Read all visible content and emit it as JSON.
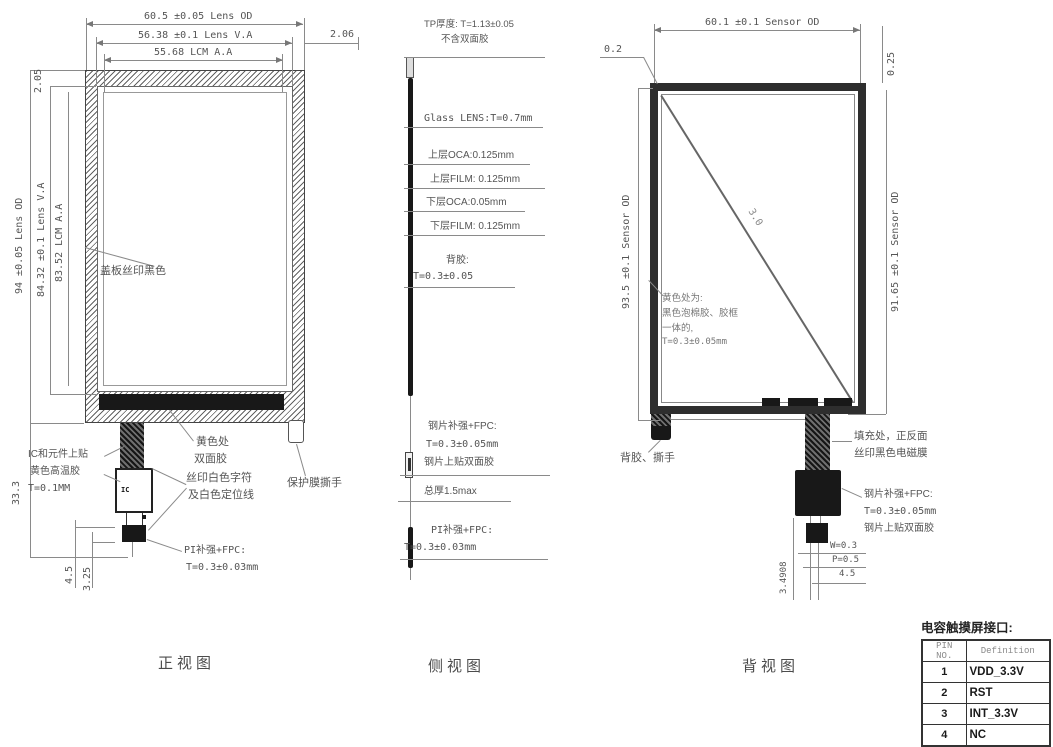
{
  "drawing": {
    "front": {
      "title": "正视图",
      "dim_lens_od_w": "60.5 ±0.05 Lens OD",
      "dim_lens_va_w": "56.38 ±0.1 Lens V.A",
      "dim_lcm_aa_w": "55.68 LCM A.A",
      "dim_offset_right": "2.06",
      "dim_offset_top": "2.05",
      "dim_lens_od_h": "94 ±0.05 Lens OD",
      "dim_lens_va_h": "84.32 ±0.1 Lens V.A",
      "dim_lcm_aa_h": "83.52 LCM A.A",
      "dim_tail_total": "33.3",
      "dim_tail_a": "4.5",
      "dim_tail_b": "3.25",
      "label_cover": "盖板丝印黑色",
      "label_ic_1": "IC和元件上贴",
      "label_ic_2": "黄色高温胶",
      "label_ic_3": "T=0.1MM",
      "label_yellow_1": "黄色处",
      "label_yellow_2": "双面胶",
      "label_silk_1": "丝印白色字符",
      "label_silk_2": "及白色定位线",
      "label_protect": "保护膜撕手",
      "label_pi_1": "PI补强+FPC:",
      "label_pi_2": "T=0.3±0.03mm",
      "ic_text": "IC"
    },
    "side": {
      "title": "侧视图",
      "tp_1": "TP厚度: T=1.13±0.05",
      "tp_2": "不含双面胶",
      "glass": "Glass LENS:T=0.7mm",
      "oca_top": "上层OCA:0.125mm",
      "film_top": "上层FILM: 0.125mm",
      "oca_bot": "下层OCA:0.05mm",
      "film_bot": "下层FILM: 0.125mm",
      "adhesive_1": "背胶:",
      "adhesive_2": "T=0.3±0.05",
      "steel_1": "钢片补强+FPC:",
      "steel_2": "T=0.3±0.05mm",
      "steel_3": "钢片上贴双面胶",
      "total": "总厚1.5max",
      "pi_1": "PI补强+FPC:",
      "pi_2": "T=0.3±0.03mm"
    },
    "back": {
      "title": "背视图",
      "dim_sensor_od_w": "60.1 ±0.1 Sensor OD",
      "dim_left_offset": "0.2",
      "dim_right_offset": "0.25",
      "dim_sensor_od_h_left": "93.5 ±0.1 Sensor OD",
      "dim_sensor_od_h_right": "91.65 ±0.1 Sensor OD",
      "diag_label": "3.0",
      "foam_1": "黄色处为:",
      "foam_2": "黑色泡棉胶、胶框",
      "foam_3": "一体的,",
      "foam_4": "T=0.3±0.05mm",
      "label_back_adhesive": "背胶、撕手",
      "fill_1": "填充处，正反面",
      "fill_2": "丝印黑色电磁膜",
      "steel_1": "钢片补强+FPC:",
      "steel_2": "T=0.3±0.05mm",
      "steel_3": "钢片上贴双面胶",
      "dim_w": "W=0.3",
      "dim_p": "P=0.5",
      "dim_45": "4.5",
      "dim_349": "3.4908"
    },
    "pin_table": {
      "title": "电容触摸屏接口:",
      "headers": [
        "PIN NO.",
        "Definition"
      ],
      "rows": [
        {
          "pin": "1",
          "def": "VDD_3.3V"
        },
        {
          "pin": "2",
          "def": "RST"
        },
        {
          "pin": "3",
          "def": "INT_3.3V"
        },
        {
          "pin": "4",
          "def": "NC"
        }
      ]
    }
  }
}
